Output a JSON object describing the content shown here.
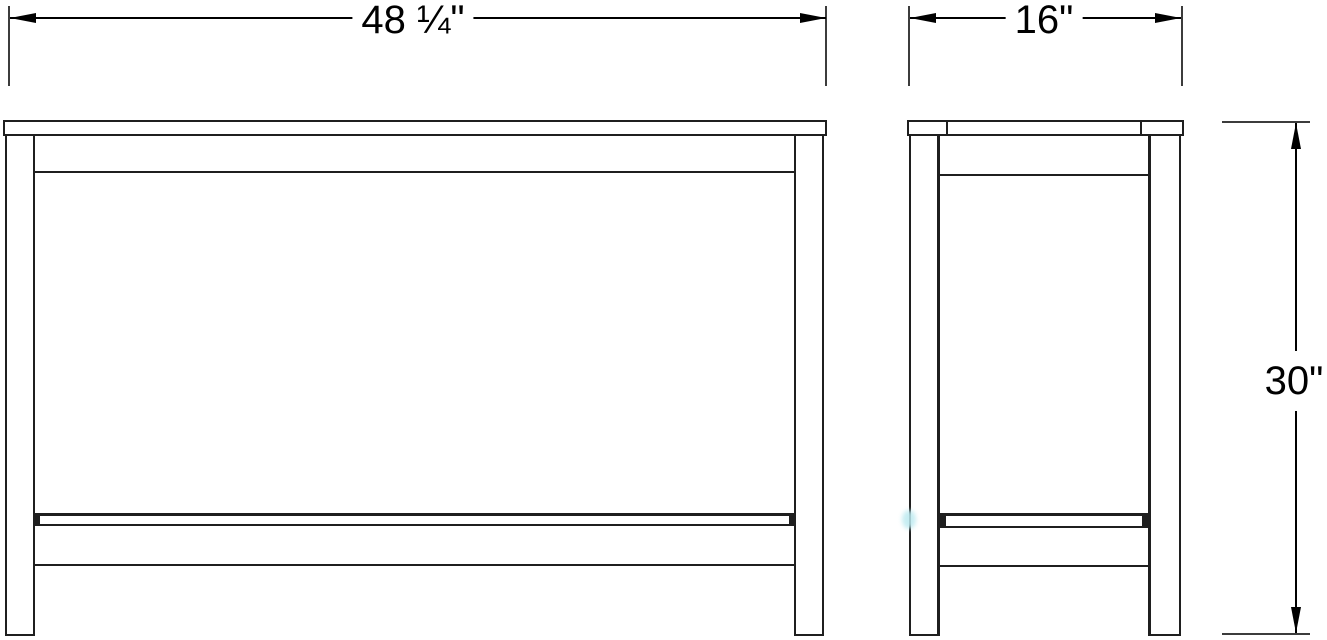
{
  "drawing": {
    "kind": "furniture-orthographic-dimension-drawing",
    "views": {
      "front": {
        "name": "front view"
      },
      "side": {
        "name": "side view"
      }
    }
  },
  "dimensions": {
    "width": {
      "label": "48 ¼\""
    },
    "depth": {
      "label": "16\""
    },
    "height": {
      "label": "30\""
    }
  },
  "colors": {
    "background": "#ffffff",
    "line": "#1f1f1f",
    "dimension_line": "#000000",
    "extension_line": "#3c3c3c",
    "text": "#000000",
    "artifact_cyan": "#bdeaf0"
  }
}
